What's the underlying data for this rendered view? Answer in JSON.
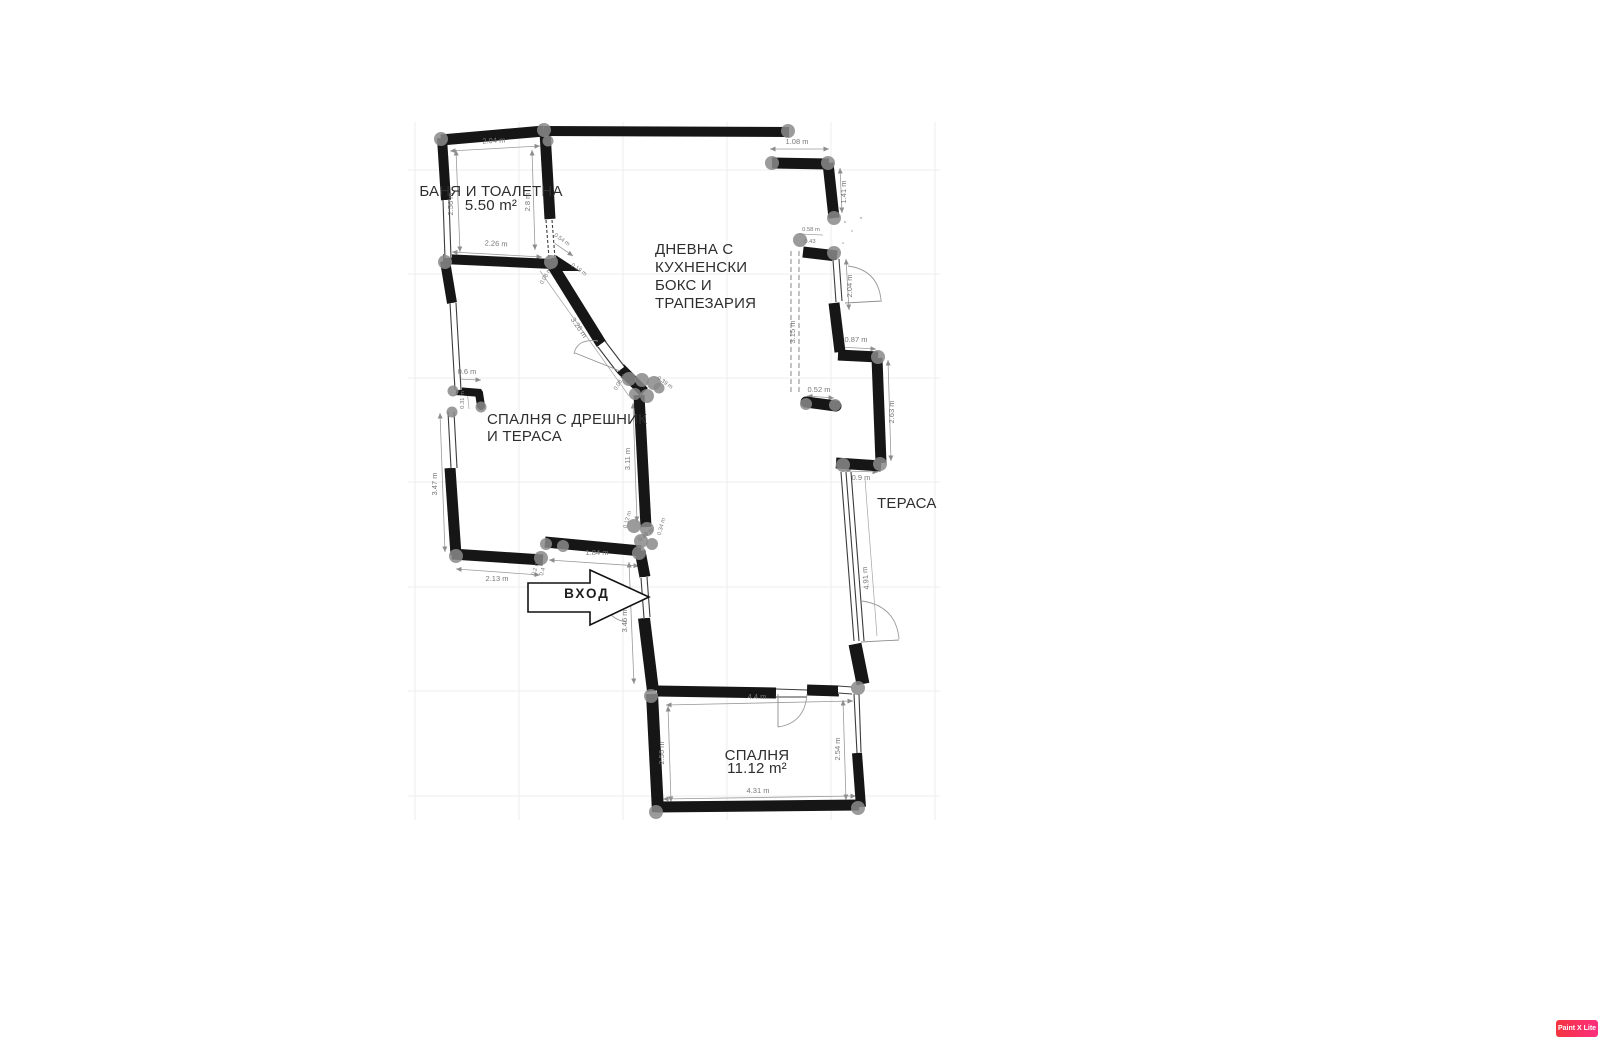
{
  "plan": {
    "rooms": {
      "bathroom": {
        "name": "БАНЯ И ТОАЛЕТНА",
        "area": "5.50 m²"
      },
      "living_room": {
        "lines": [
          "ДНЕВНА С",
          "КУХНЕНСКИ",
          "БОКС И",
          "ТРАПЕЗАРИЯ"
        ]
      },
      "bedroom_left": {
        "lines": [
          "СПАЛНЯ С ДРЕШНИК",
          "И ТЕРАСА"
        ]
      },
      "terrace": {
        "name": "ТЕРАСА"
      },
      "bedroom_bottom": {
        "name": "СПАЛНЯ",
        "area": "11.12 m²"
      },
      "entrance": {
        "name": "ВХОД"
      }
    },
    "dimensions": {
      "bath_top": "2.04 m",
      "bath_left": "2.56 m",
      "bath_right": "2.8 m",
      "bath_bottom": "2.26 m",
      "bath_corner": "0.54 m",
      "corner_a": "0.19 m",
      "corner_b": "0.08 m",
      "tr_width": "1.08 m",
      "tr_height": "1.41 m",
      "tr_small": "0.58 m",
      "tr_small2": "0.43",
      "right_dash": "3.15 m",
      "right_step": "0.87 m",
      "right_wall": "2.63 m",
      "right_small": "0.52 m",
      "right_window": "2.04 m",
      "terrace_top": "0.9 m",
      "terrace_window": "4.91 m",
      "ward_w": "0.6 m",
      "ward_h": "0.31 m",
      "left_wall": "3.47 m",
      "bottom_left": "2.13 m",
      "bottom_small_a": "0.2 m",
      "bottom_small_b": "0.4",
      "hall": "1.84 m",
      "center_wall": "3.11 m",
      "diag": "3.26 m",
      "ent_wall": "3.46 m",
      "bed_top": "4.4 m",
      "bed_left": "2.56 m",
      "bed_right": "2.54 m",
      "bed_bottom": "4.31 m",
      "cl_a": "0.39 m",
      "cl_b": "0.08 m",
      "cl_c": "0.12 m",
      "cl_d": "0.34 m",
      "cl_e": "0.49 m"
    }
  },
  "watermark": {
    "label": "Paint X Lite"
  }
}
